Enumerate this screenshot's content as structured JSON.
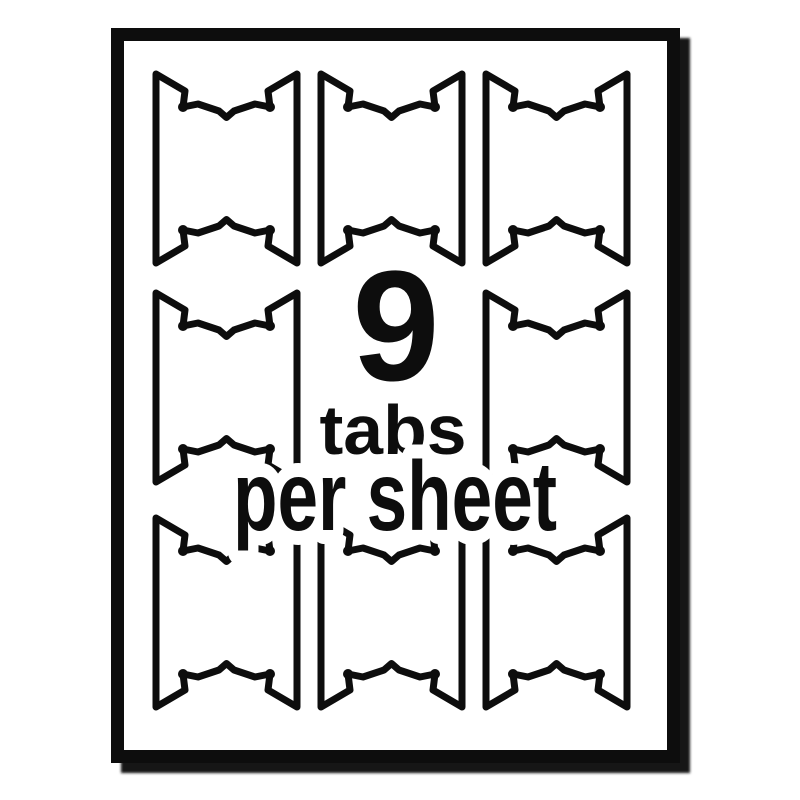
{
  "overlay": {
    "count": "9",
    "unit": "tabs",
    "per_sheet": "per sheet"
  },
  "graphic": {
    "description": "Line-art sheet of printable index tabs; 3x3 grid of die-cut tab outlines, center cell replaced by caption text",
    "ink_color": "#0d0d0d",
    "paper_color": "#ffffff",
    "shadow_color": "#161616",
    "background_color": "#ffffff",
    "tabs_drawn": 8,
    "grid": {
      "columns_x": [
        156,
        321,
        486
      ],
      "rows_y": [
        74,
        293,
        518
      ],
      "tab_width": 141,
      "tab_height": 189,
      "hidden_cell": {
        "row": 1,
        "col": 1
      }
    }
  }
}
